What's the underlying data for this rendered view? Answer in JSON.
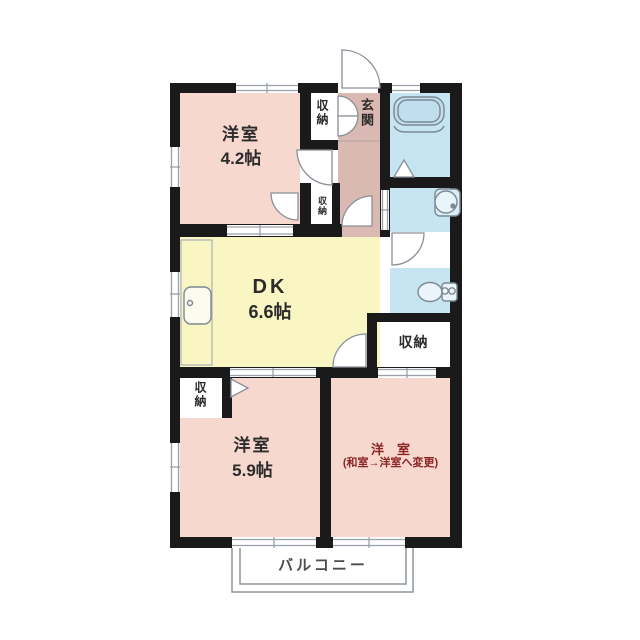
{
  "floorplan": {
    "type": "apartment-floor-plan",
    "rooms": {
      "bedroom_top": {
        "name": "洋室",
        "size": "4.2帖"
      },
      "dining_kitchen": {
        "name": "DK",
        "size": "6.6帖"
      },
      "bedroom_left": {
        "name": "洋室",
        "size": "5.9帖"
      },
      "bedroom_right": {
        "name": "洋　室",
        "note": "(和室→洋室へ変更)"
      },
      "entrance": {
        "name": "玄関"
      },
      "balcony": {
        "name": "バルコニー"
      },
      "closet_top": {
        "name": "収納"
      },
      "closet_small": {
        "name": "収納"
      },
      "closet_right": {
        "name": "収納"
      },
      "closet_bottom": {
        "name": "収納"
      }
    },
    "colors": {
      "wall": "#1a1a1a",
      "western_room": "#f6d8cf",
      "dining_kitchen": "#faf6c3",
      "hallway_entrance": "#d9b9b1",
      "wet_area": "#c6e4f2",
      "renovation_note_text": "#8d2424",
      "label_text": "#2b2b2b"
    }
  }
}
